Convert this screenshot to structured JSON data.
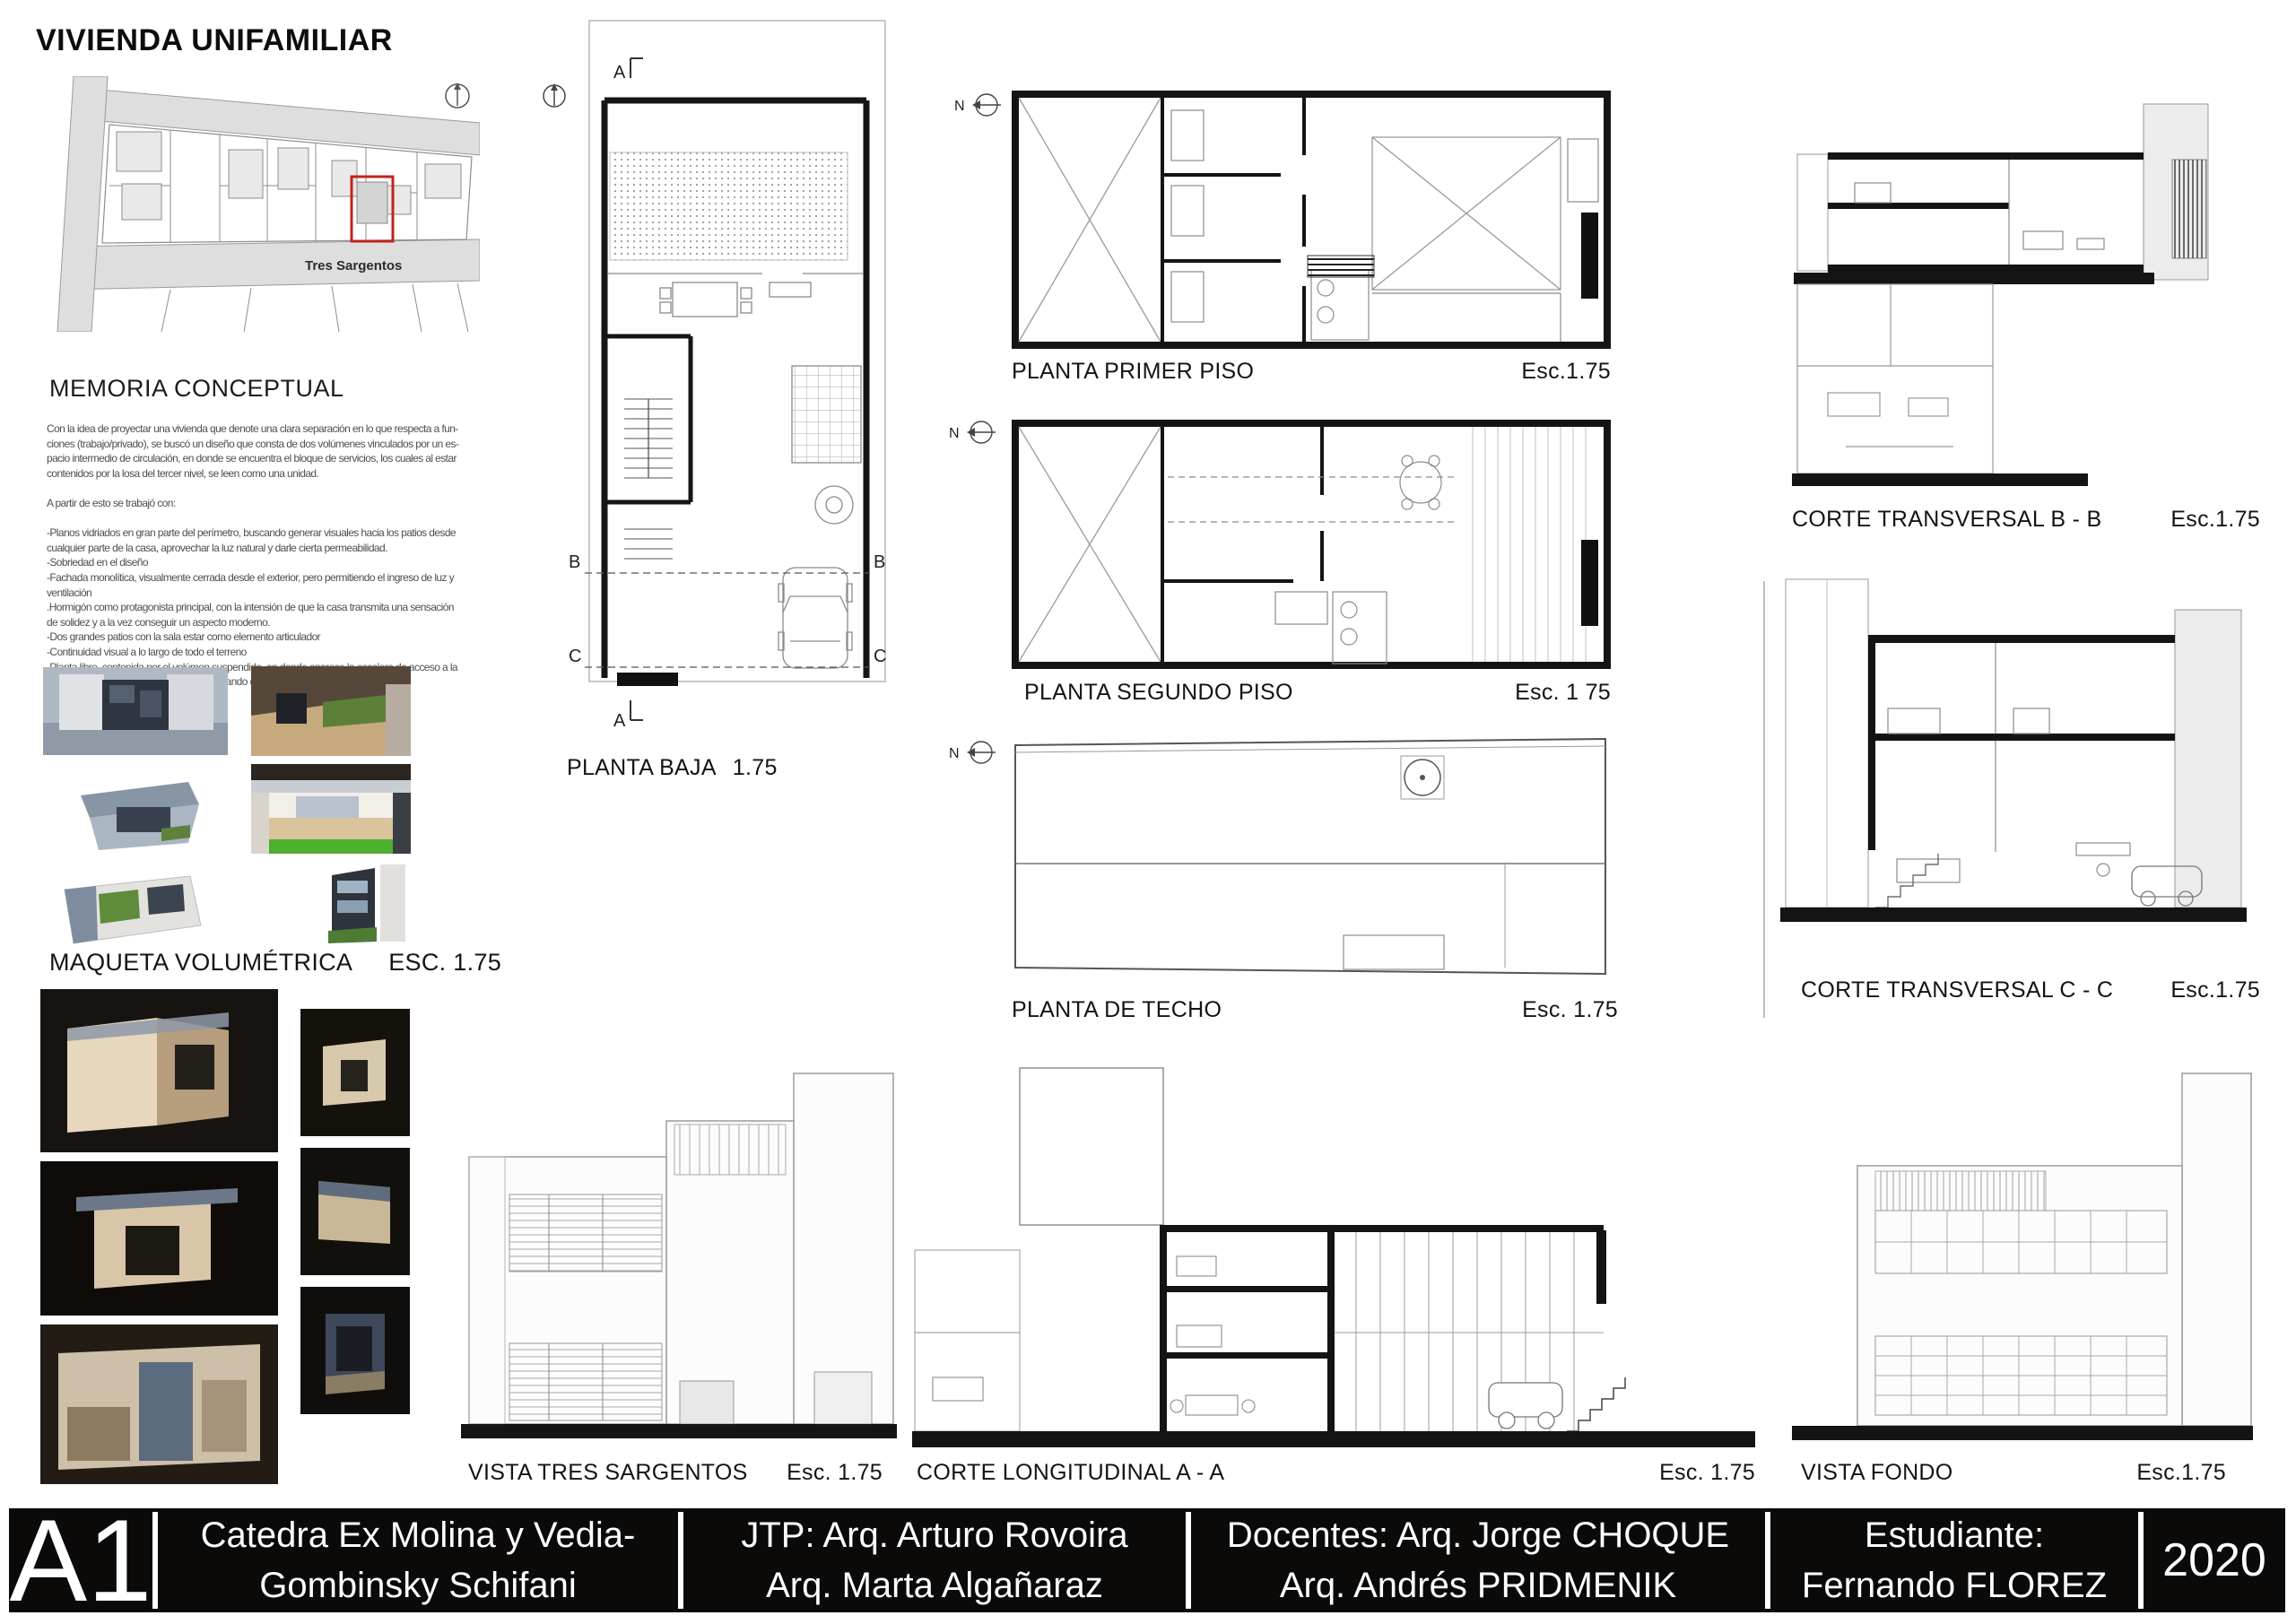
{
  "page": {
    "title": "VIVIENDA UNIFAMILIAR"
  },
  "site_plan": {
    "street": "Tres Sargentos"
  },
  "memoria": {
    "heading": "MEMORIA CONCEPTUAL",
    "lines": [
      "Con la idea de proyectar una vivienda que denote una clara separación en lo que respecta a fun-",
      "ciones (trabajo/privado), se buscó un diseño que consta de dos volúmenes vinculados por un es-",
      "pacio intermedio de circulación, en donde se encuentra el bloque de servicios, los cuales al estar",
      "contenidos por la losa del tercer nivel, se leen como una unidad.",
      "",
      "A partir de esto se trabajó con:",
      "",
      "-Planos vidriados en gran parte del perímetro, buscando generar visuales hacia los  patios desde",
      "cualquier parte de la casa, aprovechar la luz natural y darle cierta permeabilidad.",
      "-Sobriedad en el diseño",
      "-Fachada monolítica, visualmente cerrada desde el exterior, pero permitiendo el ingreso de luz y",
      "ventilación",
      ".Hormigón como protagonista principal, con la intensión de que la casa transmita una sensación",
      "de solidez y a la vez conseguir un aspecto moderno.",
      "-Dos grandes patios con la sala estar como elemento articulador",
      "-Continuidad visual a lo largo de todo el terreno",
      "-Planta libre, contenida por el volúmen suspendido, en donde aparece la escalera de acceso a la",
      "zona de trabajo como único elemento, tratando de no irrumpir esa continuidad visual."
    ]
  },
  "maqueta": {
    "heading": "MAQUETA VOLUMÉTRICA",
    "scale": "ESC. 1.75"
  },
  "markers": {
    "north": "N",
    "a": "A",
    "b": "B",
    "c": "C"
  },
  "plans": {
    "baja": {
      "name": "PLANTA BAJA",
      "scale": "1.75"
    },
    "primer": {
      "name": "PLANTA PRIMER PISO",
      "scale": "Esc.1.75"
    },
    "segundo": {
      "name": "PLANTA SEGUNDO PISO",
      "scale": "Esc.  1 75"
    },
    "techo": {
      "name": "PLANTA DE TECHO",
      "scale": "Esc.  1.75"
    }
  },
  "cortes": {
    "bb": {
      "name": "CORTE TRANSVERSAL B - B",
      "scale": "Esc.1.75"
    },
    "cc": {
      "name": "CORTE TRANSVERSAL C - C",
      "scale": "Esc.1.75"
    },
    "aa": {
      "name": "CORTE LONGITUDINAL  A - A",
      "scale": "Esc. 1.75"
    }
  },
  "vistas": {
    "tres_sargentos": {
      "name": "VISTA TRES SARGENTOS",
      "scale": "Esc. 1.75"
    },
    "fondo": {
      "name": "VISTA FONDO",
      "scale": "Esc.1.75"
    }
  },
  "titleblock": {
    "sheet": "A1",
    "catedra": [
      "Catedra Ex Molina y Vedia-",
      "Gombinsky Schifani"
    ],
    "jtp": [
      "JTP: Arq. Arturo Rovoira",
      "Arq. Marta Algañaraz"
    ],
    "docentes": [
      "Docentes: Arq. Jorge CHOQUE",
      "Arq. Andrés PRIDMENIK"
    ],
    "estudiante": [
      "Estudiante:",
      "Fernando FLOREZ"
    ],
    "year": "2020"
  },
  "colors": {
    "accent_red": "#c0241c",
    "titlebar_bg": "#0c0909",
    "street_grey": "#dedede"
  }
}
